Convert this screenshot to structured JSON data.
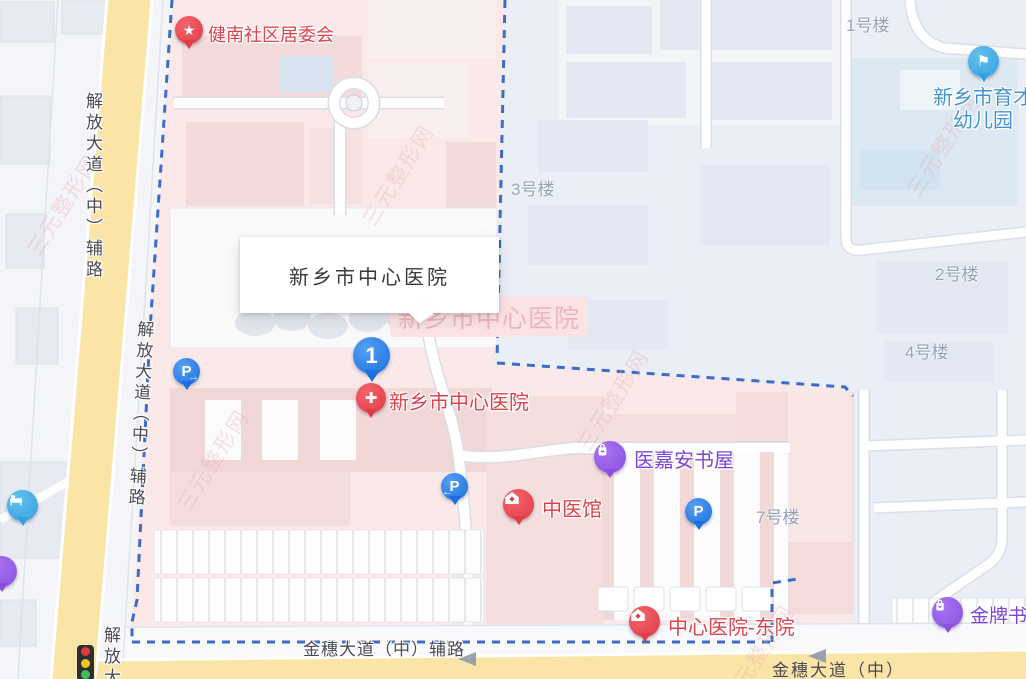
{
  "infobox": {
    "title": "新乡市中心医院"
  },
  "selected": {
    "number": "1",
    "pin_glyph": "✚",
    "label": "新乡市中心医院"
  },
  "faded_label": "新乡市中心医院",
  "pois": {
    "community": {
      "label": "健南社区居委会",
      "glyph": "★"
    },
    "kindergarten": {
      "line1": "新乡市育才",
      "line2": "幼儿园",
      "glyph": "⚑"
    },
    "bookstore": {
      "label": "医嘉安书屋"
    },
    "tcm": {
      "label": "中医馆"
    },
    "east_hospital": {
      "label": "中心医院-东院"
    },
    "gold_bookstore": {
      "label": "金牌书"
    }
  },
  "parking": {
    "p": "P",
    "p1_arrow": "→",
    "p2_arrow": "←"
  },
  "buildings": {
    "b1": "1号楼",
    "b2": "2号楼",
    "b3": "3号楼",
    "b4": "4号楼",
    "b7": "7号楼"
  },
  "roads": {
    "jiefang_upper": "解放大道（中）辅路",
    "jiefang_lower": "解放大道（中）辅路",
    "jiefang_cut": "解放大",
    "jinsui_service": "金穗大道（中）辅路",
    "jinsui_main": "金穗大道（中）"
  },
  "watermark": "三元整形网",
  "colors": {
    "selected_blue": "#1B6FE0",
    "poi_red": "#D8434E",
    "poi_purple": "#7C45DA",
    "marker_red": "#E13B46",
    "marker_purple": "#8B4FE0",
    "parking_blue": "#1B6FE0",
    "boundary_blue": "#3E6BC4",
    "campus_pink": "#FAE9E8",
    "main_road_yellow": "#FBE5A6"
  }
}
